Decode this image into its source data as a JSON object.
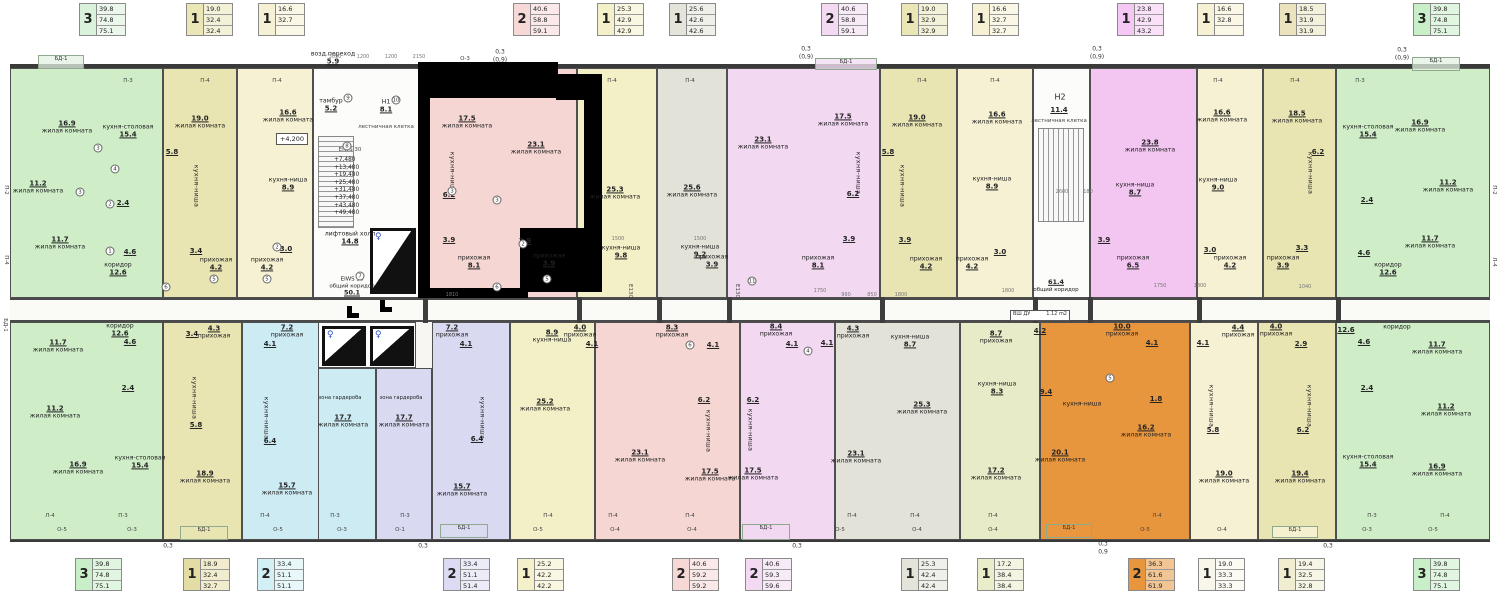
{
  "colors": {
    "wall": "#4f4f4f",
    "green": "#cfeec8",
    "khaki": "#e9e5b3",
    "cream": "#f6f1d3",
    "pink": "#f5d6d3",
    "yellow": "#f3efc7",
    "gray": "#e2e2d9",
    "purple": "#f2d8f1",
    "magenta": "#f3c6f1",
    "cyan": "#cdebf3",
    "lavender": "#d9daf1",
    "olive": "#e8ebc8",
    "orange": "#e8963e",
    "highlight": "#000000"
  },
  "lt": [
    [
      "3",
      "39.8",
      "74.8",
      "75.1"
    ],
    [
      "1",
      "19.0",
      "32.4",
      "32.4"
    ],
    [
      "1",
      "16.6",
      "32.7",
      ""
    ],
    [
      "2",
      "40.6",
      "58.8",
      "59.1"
    ],
    [
      "1",
      "25.3",
      "42.9",
      "42.9"
    ],
    [
      "1",
      "25.6",
      "42.6",
      "42.6"
    ],
    [
      "2",
      "40.6",
      "58.8",
      "59.1"
    ],
    [
      "1",
      "19.0",
      "32.9",
      "32.9"
    ],
    [
      "1",
      "16.6",
      "32.7",
      "32.7"
    ],
    [
      "1",
      "23.8",
      "42.9",
      "43.2"
    ],
    [
      "1",
      "16.6",
      "32.8",
      ""
    ],
    [
      "1",
      "18.5",
      "31.9",
      "31.9"
    ],
    [
      "3",
      "39.8",
      "74.8",
      "75.1"
    ]
  ],
  "lb": [
    [
      "3",
      "39.8",
      "74.8",
      "75.1"
    ],
    [
      "1",
      "18.9",
      "32.4",
      "32.7"
    ],
    [
      "2",
      "33.4",
      "51.1",
      "51.1"
    ],
    [
      "2",
      "33.4",
      "51.1",
      "51.4"
    ],
    [
      "1",
      "25.2",
      "42.2",
      "42.2"
    ],
    [
      "2",
      "40.6",
      "59.2",
      "59.2"
    ],
    [
      "2",
      "40.6",
      "59.3",
      "59.6"
    ],
    [
      "1",
      "25.3",
      "42.4",
      "42.4"
    ],
    [
      "1",
      "17.2",
      "38.4",
      "38.4"
    ],
    [
      "2",
      "36.3",
      "61.6",
      "61.9"
    ],
    [
      "1",
      "19.0",
      "33.3",
      "33.3"
    ],
    [
      "1",
      "19.4",
      "32.5",
      "32.8"
    ],
    [
      "3",
      "39.8",
      "74.8",
      "75.1"
    ]
  ],
  "t0": [
    [
      "жилая комната",
      "16.9"
    ],
    [
      "кухня-столовая",
      "15.4"
    ],
    [
      "жилая комната",
      "11.2"
    ],
    [
      "",
      "2.4"
    ],
    [
      "жилая комната",
      "11.7"
    ],
    [
      "",
      "4.6"
    ],
    [
      "коридор",
      "12.6"
    ]
  ],
  "t1": [
    [
      "жилая комната",
      "19.0"
    ],
    [
      "",
      "5.8"
    ],
    [
      "кухня-ниша",
      ""
    ],
    [
      "",
      "3.4"
    ],
    [
      "прихожая",
      "4.2"
    ]
  ],
  "t2": [
    [
      "жилая комната",
      "16.6"
    ],
    [
      "кухня-ниша",
      "8.9"
    ],
    [
      "",
      "3.0"
    ],
    [
      "прихожая",
      "4.2"
    ]
  ],
  "t3": [
    [
      "жилая комната",
      "17.5"
    ],
    [
      "кухня-ниша",
      ""
    ],
    [
      "",
      "6.2"
    ],
    [
      "жилая комната",
      "23.1"
    ],
    [
      "",
      "3.9"
    ],
    [
      "прихожая",
      "8.1"
    ]
  ],
  "t4": [
    [
      "жилая комната",
      "25.3"
    ],
    [
      "кухня-ниша",
      "9.8"
    ],
    [
      "",
      "3.9"
    ],
    [
      "прихожая",
      "3.9"
    ]
  ],
  "t5": [
    [
      "жилая комната",
      "25.6"
    ],
    [
      "кухня-ниша",
      "9.2"
    ],
    [
      "прихожая",
      "3.9"
    ]
  ],
  "t6": [
    [
      "жилая комната",
      "23.1"
    ],
    [
      "жилая комната",
      "17.5"
    ],
    [
      "кухня-ниша",
      ""
    ],
    [
      "",
      "6.2"
    ],
    [
      "",
      "3.9"
    ],
    [
      "прихожая",
      "8.1"
    ]
  ],
  "t7": [
    [
      "жилая комната",
      "19.0"
    ],
    [
      "",
      "5.8"
    ],
    [
      "кухня-ниша",
      ""
    ],
    [
      "",
      "3.9"
    ],
    [
      "прихожая",
      "4.2"
    ]
  ],
  "t8": [
    [
      "жилая комната",
      "16.6"
    ],
    [
      "кухня-ниша",
      "8.9"
    ],
    [
      "",
      "3.0"
    ],
    [
      "прихожая",
      "4.2"
    ]
  ],
  "t9": [
    [
      "жилая комната",
      "23.8"
    ],
    [
      "кухня-ниша",
      "8.7"
    ],
    [
      "",
      "3.9"
    ],
    [
      "прихожая",
      "6.5"
    ]
  ],
  "t10": [
    [
      "жилая комната",
      "16.6"
    ],
    [
      "кухня-ниша",
      "9.0"
    ],
    [
      "",
      "3.0"
    ],
    [
      "прихожая",
      "4.2"
    ]
  ],
  "t11": [
    [
      "жилая комната",
      "18.5"
    ],
    [
      "",
      "6.2"
    ],
    [
      "кухня-ниша",
      ""
    ],
    [
      "",
      "3.3"
    ],
    [
      "прихожая",
      "3.9"
    ]
  ],
  "t12": [
    [
      "кухня-столовая",
      "15.4"
    ],
    [
      "жилая комната",
      "16.9"
    ],
    [
      "жилая комната",
      "11.2"
    ],
    [
      "",
      "2.4"
    ],
    [
      "жилая комната",
      "11.7"
    ],
    [
      "",
      "4.6"
    ],
    [
      "коридор",
      "12.6"
    ]
  ],
  "b0": [
    [
      "жилая комната",
      "11.7"
    ],
    [
      "коридор",
      "12.6"
    ],
    [
      "",
      "4.6"
    ],
    [
      "",
      "2.4"
    ],
    [
      "жилая комната",
      "11.2"
    ],
    [
      "жилая комната",
      "16.9"
    ],
    [
      "кухня-столовая",
      "15.4"
    ]
  ],
  "b1": [
    [
      "прихожая",
      "4.3"
    ],
    [
      "",
      "3.4"
    ],
    [
      "кухня-ниша",
      ""
    ],
    [
      "",
      "5.8"
    ],
    [
      "жилая комната",
      "18.9"
    ]
  ],
  "b2": [
    [
      "прихожая",
      "7.2"
    ],
    [
      "",
      "4.1"
    ],
    [
      "кухня-ниша",
      ""
    ],
    [
      "",
      "6.4"
    ],
    [
      "зона гардероба",
      ""
    ],
    [
      "жилая комната",
      "17.7"
    ],
    [
      "жилая комната",
      "15.7"
    ]
  ],
  "b3": [
    [
      "прихожая",
      "7.2"
    ],
    [
      "",
      "4.1"
    ],
    [
      "зона гардероба",
      ""
    ],
    [
      "жилая комната",
      "17.7"
    ],
    [
      "кухня-ниша",
      ""
    ],
    [
      "",
      "6.4"
    ],
    [
      "жилая комната",
      "15.7"
    ]
  ],
  "b4": [
    [
      "кухня-ниша",
      "8.9"
    ],
    [
      "прихожая",
      "4.0"
    ],
    [
      "",
      "4.1"
    ],
    [
      "жилая комната",
      "25.2"
    ]
  ],
  "b5": [
    [
      "прихожая",
      "8.3"
    ],
    [
      "",
      "4.1"
    ],
    [
      "",
      "6.2"
    ],
    [
      "кухня-ниша",
      ""
    ],
    [
      "жилая комната",
      "23.1"
    ],
    [
      "жилая комната",
      "17.5"
    ]
  ],
  "b6": [
    [
      "прихожая",
      "8.4"
    ],
    [
      "",
      "4.1"
    ],
    [
      "",
      "6.2"
    ],
    [
      "кухня-ниша",
      ""
    ],
    [
      "жилая комната",
      "17.5"
    ],
    [
      "жилая комната",
      "23.1"
    ]
  ],
  "b7": [
    [
      "прихожая",
      "4.3"
    ],
    [
      "",
      "4.1"
    ],
    [
      "кухня-ниша",
      "8.7"
    ],
    [
      "жилая комната",
      "25.3"
    ]
  ],
  "b8": [
    [
      "прихожая",
      "8.7"
    ],
    [
      "",
      "4.2"
    ],
    [
      "кухня-ниша",
      "8.3"
    ],
    [
      "жилая комната",
      "17.2"
    ]
  ],
  "b9": [
    [
      "прихожая",
      "10.0"
    ],
    [
      "",
      "4.1"
    ],
    [
      "",
      "9.4"
    ],
    [
      "кухня-ниша",
      ""
    ],
    [
      "",
      "1.8"
    ],
    [
      "жилая комната",
      "16.2"
    ],
    [
      "жилая комната",
      "20.1"
    ]
  ],
  "b10": [
    [
      "",
      "4.1"
    ],
    [
      "прихожая",
      "4.4"
    ],
    [
      "кухня-ниша",
      ""
    ],
    [
      "",
      "5.8"
    ],
    [
      "жилая комната",
      "19.0"
    ]
  ],
  "b11": [
    [
      "прихожая",
      "4.0"
    ],
    [
      "",
      "2.9"
    ],
    [
      "кухня-ниша",
      ""
    ],
    [
      "",
      "6.2"
    ],
    [
      "жилая комната",
      "19.4"
    ]
  ],
  "b12": [
    [
      "",
      "12.6"
    ],
    [
      "коридор",
      ""
    ],
    [
      "жилая комната",
      "11.7"
    ],
    [
      "",
      "4.6"
    ],
    [
      "",
      "2.4"
    ],
    [
      "жилая комната",
      "11.2"
    ],
    [
      "кухня-столовая",
      "15.4"
    ],
    [
      "жилая комната",
      "16.9"
    ]
  ],
  "c1": {
    "a": "тамбур",
    "a2": "5.2",
    "b": "Н1",
    "b2": "8.1",
    "st": "лестничная клетка",
    "e": "EIWS 30",
    "lv": [
      "+7,480",
      "+13,480",
      "+19,480",
      "+25,480",
      "+31,480",
      "+37,480",
      "+43,480",
      "+49,480"
    ],
    "lf": "лифтовый холл",
    "lf2": "14.8",
    "br": "возд.переход",
    "br2": "5.9",
    "k1": "EIWS 30",
    "k2": "общий коридор",
    "k3": "50.1",
    "lvl": "+4,200"
  },
  "c2": {
    "h": "Н2",
    "h2": "11.4",
    "st": "лестничная клетка",
    "k1": "61.4",
    "k2": "общий коридор",
    "sh": "ВШ ДУ",
    "sh2": "1.12 m2",
    "e": "Е130"
  },
  "bd": "БД-1",
  "mt": [
    "П-3",
    "П-4",
    "П-4",
    "О-3",
    "П-4",
    "П-4",
    "П-4",
    "П-4",
    "П-4",
    "П-4",
    "П-3"
  ],
  "mb1": [
    "Л-4",
    "П-3",
    "П-4",
    "П-3",
    "П-3",
    "П-4",
    "П-4",
    "П-4",
    "П-4",
    "П-4",
    "П-4",
    "Л-4",
    "П-3",
    "П-4"
  ],
  "mb2": [
    "О-5",
    "О-3",
    "О-5",
    "О-3",
    "О-1",
    "О-5",
    "О-4",
    "О-4",
    "О-5",
    "О-4",
    "О-4",
    "О-5",
    "О-4",
    "О-3",
    "О-5"
  ],
  "side": [
    "П-2",
    "П-4",
    "БД-1",
    "П-2",
    "Л-4"
  ],
  "z": [
    "0,3",
    "(0,9)",
    "0,3",
    "(0,9)",
    "0,3",
    "(0,9)",
    "0,3",
    "(0,9)",
    "0,3",
    "0,3",
    "0,3",
    "0,3",
    "0,9",
    "0,3"
  ],
  "dm": [
    "3050",
    "1200",
    "1200",
    "2150",
    "1500",
    "1500",
    "1810",
    "1750",
    "990",
    "850",
    "1800",
    "1800",
    "2600",
    "1750",
    "1800",
    "1040",
    "180"
  ],
  "ci": [
    "3",
    "4",
    "2",
    "1",
    "3",
    "6",
    "5",
    "2",
    "5",
    "9",
    "8",
    "7",
    "10",
    "3",
    "3",
    "2",
    "5",
    "6",
    "11",
    "4",
    "6",
    "5"
  ]
}
